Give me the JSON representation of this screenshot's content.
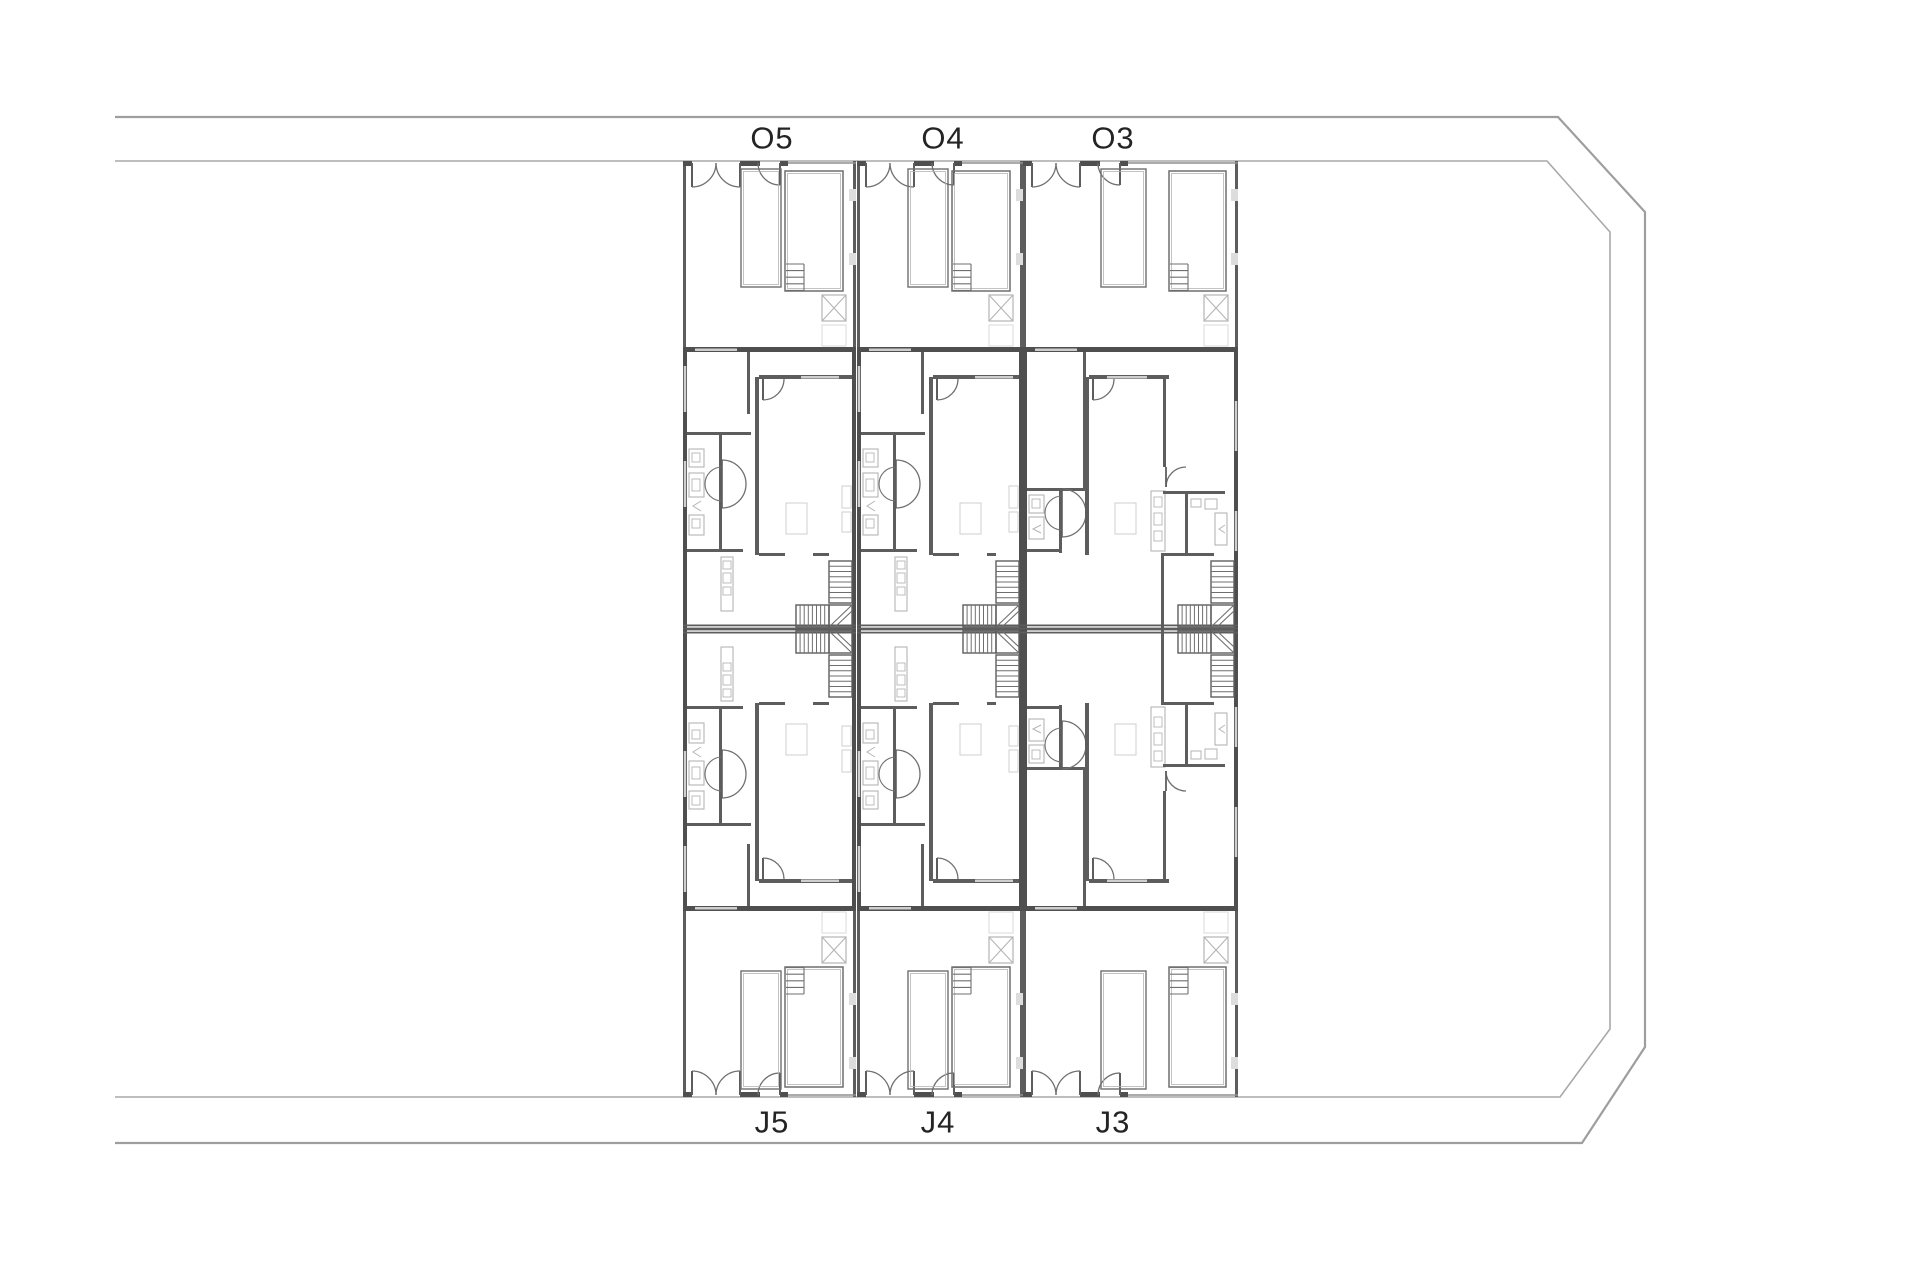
{
  "page": {
    "kind": "architectural-site-floor-plan",
    "background": "#ffffff"
  },
  "colors": {
    "boundary_outer": "#9e9e9e",
    "boundary_inner": "#a8a8a8",
    "wall_dark": "#4f4f4f",
    "wall_mid": "#5d5d5d",
    "wall_thin": "#6f6f6f",
    "fence_thin": "#8f8f8f",
    "fixture_light": "#b5b5b5",
    "faint": "#cfcfcf",
    "very_faint": "#dddddd",
    "label_text": "#242424"
  },
  "site": {
    "outer_boundary_points": [
      [
        115,
        117
      ],
      [
        1558,
        117
      ],
      [
        1645,
        212
      ],
      [
        1645,
        1047
      ],
      [
        1582,
        1143
      ],
      [
        115,
        1143
      ]
    ],
    "inner_boundary_points": [
      [
        115,
        161
      ],
      [
        1547,
        161
      ],
      [
        1610,
        232
      ],
      [
        1610,
        1029
      ],
      [
        1560,
        1097
      ],
      [
        115,
        1097
      ]
    ]
  },
  "rows": {
    "top_row_labels": [
      "O5",
      "O4",
      "O3"
    ],
    "bottom_row_labels": [
      "J5",
      "J4",
      "J3"
    ]
  },
  "units": [
    {
      "id": "O5",
      "label": "O5",
      "x": 683,
      "width": 173,
      "side": "top",
      "variant": "narrow",
      "label_cx": 772,
      "label_cy": 138
    },
    {
      "id": "O4",
      "label": "O4",
      "x": 857,
      "width": 166,
      "side": "top",
      "variant": "narrow",
      "label_cx": 943,
      "label_cy": 138
    },
    {
      "id": "O3",
      "label": "O3",
      "x": 1023,
      "width": 215,
      "side": "top",
      "variant": "wide",
      "label_cx": 1113,
      "label_cy": 138
    },
    {
      "id": "J5",
      "label": "J5",
      "x": 683,
      "width": 173,
      "side": "bottom",
      "variant": "narrow",
      "label_cx": 772,
      "label_cy": 1122
    },
    {
      "id": "J4",
      "label": "J4",
      "x": 857,
      "width": 166,
      "side": "bottom",
      "variant": "narrow",
      "label_cx": 938,
      "label_cy": 1122
    },
    {
      "id": "J3",
      "label": "J3",
      "x": 1023,
      "width": 215,
      "side": "bottom",
      "variant": "wide",
      "label_cx": 1113,
      "label_cy": 1122
    }
  ],
  "label_font_size": 31
}
